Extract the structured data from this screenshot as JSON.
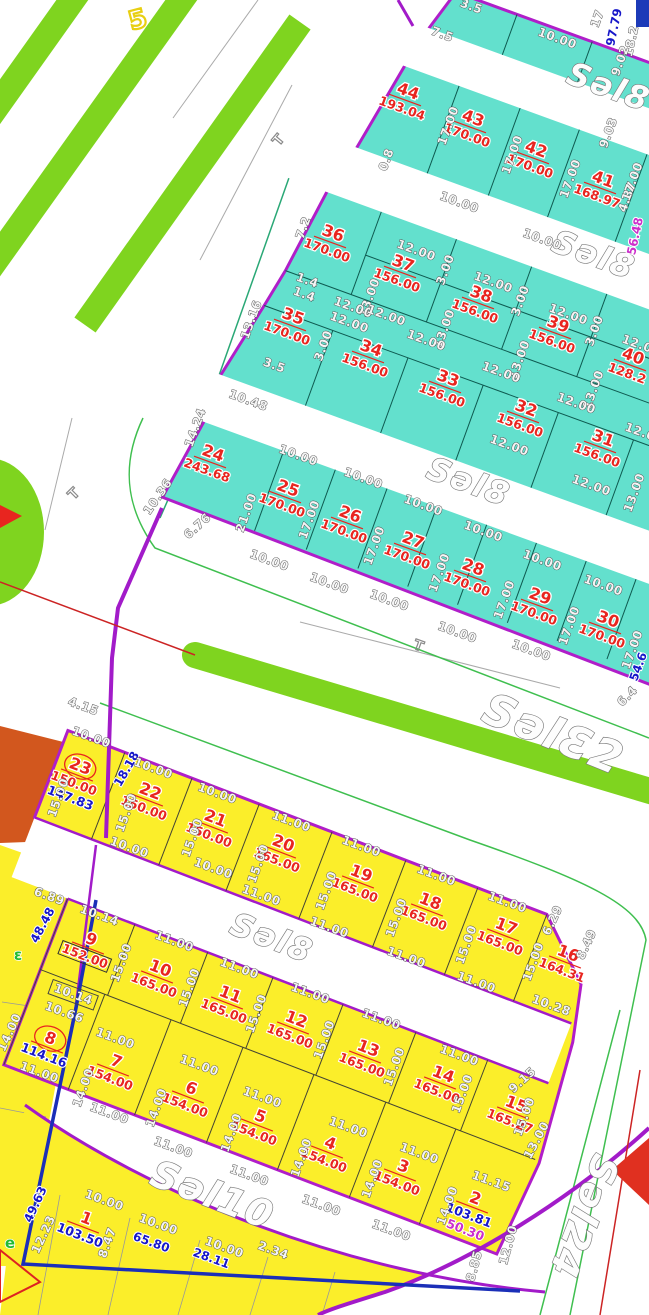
{
  "map_title": "cadastral-parcel-plan",
  "colors": {
    "cyan_block": "#63e0cd",
    "yellow_block": "#fbee2a",
    "green_strip": "#7fd41f",
    "purple_road": "#a21bc9",
    "block_border": "#b01ec9",
    "parcel_red": "#e8251f",
    "dim_blue": "#1717c9",
    "dim_magenta": "#cb2fcb",
    "orange_area": "#d2571e",
    "survey_blue": "#1b2fb8",
    "red_line": "#cc2424",
    "teal_line": "#2aa876",
    "green_line": "#3fbf4f"
  },
  "street_labels": [
    {
      "text": "Səl8",
      "x": 605,
      "y": 97,
      "r": 20,
      "s": 32
    },
    {
      "text": "Səl8",
      "x": 590,
      "y": 265,
      "r": 20,
      "s": 32
    },
    {
      "text": "Səl8",
      "x": 465,
      "y": 492,
      "r": 20,
      "s": 32
    },
    {
      "text": "SəlƐ2",
      "x": 548,
      "y": 748,
      "r": 22,
      "s": 44
    },
    {
      "text": "Səl8",
      "x": 268,
      "y": 948,
      "r": 21,
      "s": 32
    },
    {
      "text": "Səl10",
      "x": 208,
      "y": 1207,
      "r": 21,
      "s": 38
    },
    {
      "text": "Səl24",
      "x": 572,
      "y": 1212,
      "r": 111,
      "s": 38
    }
  ],
  "parcels": {
    "cyan": [
      {
        "no": "44",
        "area": "193.04",
        "x": 405,
        "y": 100,
        "r": 20
      },
      {
        "no": "43",
        "area": "170.00",
        "x": 470,
        "y": 127,
        "r": 20
      },
      {
        "no": "42",
        "area": "170.00",
        "x": 533,
        "y": 158,
        "r": 20
      },
      {
        "no": "41",
        "area": "168.97",
        "x": 600,
        "y": 188,
        "r": 20
      },
      {
        "no": "36",
        "area": "170.00",
        "x": 330,
        "y": 242,
        "r": 20
      },
      {
        "no": "37",
        "area": "156.00",
        "x": 400,
        "y": 272,
        "r": 20
      },
      {
        "no": "38",
        "area": "156.00",
        "x": 478,
        "y": 303,
        "r": 20
      },
      {
        "no": "39",
        "area": "156.00",
        "x": 555,
        "y": 333,
        "r": 20
      },
      {
        "no": "40",
        "area": "128.2",
        "x": 630,
        "y": 365,
        "r": 20
      },
      {
        "no": "35",
        "area": "170.00",
        "x": 290,
        "y": 325,
        "r": 20
      },
      {
        "no": "34",
        "area": "156.00",
        "x": 368,
        "y": 357,
        "r": 20
      },
      {
        "no": "33",
        "area": "156.00",
        "x": 445,
        "y": 387,
        "r": 20
      },
      {
        "no": "32",
        "area": "156.00",
        "x": 523,
        "y": 417,
        "r": 20
      },
      {
        "no": "31",
        "area": "156.00",
        "x": 600,
        "y": 447,
        "r": 20
      },
      {
        "no": "24",
        "area": "243.68",
        "x": 210,
        "y": 462,
        "r": 20
      },
      {
        "no": "25",
        "area": "170.00",
        "x": 285,
        "y": 497,
        "r": 20
      },
      {
        "no": "26",
        "area": "170.00",
        "x": 347,
        "y": 523,
        "r": 20
      },
      {
        "no": "27",
        "area": "170.00",
        "x": 410,
        "y": 549,
        "r": 20
      },
      {
        "no": "28",
        "area": "170.00",
        "x": 470,
        "y": 576,
        "r": 20
      },
      {
        "no": "29",
        "area": "170.00",
        "x": 537,
        "y": 605,
        "r": 20
      },
      {
        "no": "30",
        "area": "170.00",
        "x": 605,
        "y": 628,
        "r": 20
      }
    ],
    "yellow": [
      {
        "no": "23",
        "area": "150.00",
        "x": 77,
        "y": 775,
        "r": 21,
        "circled": true,
        "extra": "147.83",
        "extra_color": "#1717c9"
      },
      {
        "no": "22",
        "area": "150.00",
        "x": 147,
        "y": 800,
        "r": 21
      },
      {
        "no": "21",
        "area": "150.00",
        "x": 212,
        "y": 827,
        "r": 21
      },
      {
        "no": "20",
        "area": "165.00",
        "x": 280,
        "y": 852,
        "r": 21
      },
      {
        "no": "19",
        "area": "165.00",
        "x": 358,
        "y": 882,
        "r": 21
      },
      {
        "no": "18",
        "area": "165.00",
        "x": 427,
        "y": 910,
        "r": 21
      },
      {
        "no": "17",
        "area": "165.00",
        "x": 503,
        "y": 935,
        "r": 21
      },
      {
        "no": "16",
        "area": "164.31",
        "x": 565,
        "y": 962,
        "r": 21
      },
      {
        "no": "9",
        "area": "152.00",
        "x": 88,
        "y": 948,
        "r": 21,
        "boxed": true
      },
      {
        "no": "10",
        "area": "165.00",
        "x": 157,
        "y": 977,
        "r": 21
      },
      {
        "no": "11",
        "area": "165.00",
        "x": 227,
        "y": 1003,
        "r": 21
      },
      {
        "no": "12",
        "area": "165.00",
        "x": 293,
        "y": 1028,
        "r": 21
      },
      {
        "no": "13",
        "area": "165.00",
        "x": 365,
        "y": 1057,
        "r": 21
      },
      {
        "no": "14",
        "area": "165.00",
        "x": 440,
        "y": 1083,
        "r": 21
      },
      {
        "no": "15",
        "area": "165.27",
        "x": 513,
        "y": 1113,
        "r": 21
      },
      {
        "no": "8",
        "area": "114.16",
        "x": 47,
        "y": 1047,
        "r": 21,
        "circled": true,
        "area_blue": true
      },
      {
        "no": "7",
        "area": "154.00",
        "x": 113,
        "y": 1070,
        "r": 21
      },
      {
        "no": "6",
        "area": "154.00",
        "x": 188,
        "y": 1097,
        "r": 21
      },
      {
        "no": "5",
        "area": "154.00",
        "x": 257,
        "y": 1125,
        "r": 21
      },
      {
        "no": "4",
        "area": "154.00",
        "x": 327,
        "y": 1152,
        "r": 21
      },
      {
        "no": "3",
        "area": "154.00",
        "x": 400,
        "y": 1175,
        "r": 21
      },
      {
        "no": "2",
        "area": "103.81",
        "x": 472,
        "y": 1207,
        "r": 21,
        "area_blue": true,
        "extra": "50.30",
        "extra_color": "#cb2fcb"
      },
      {
        "no": "1",
        "area": "103.50",
        "x": 83,
        "y": 1227,
        "r": 21,
        "area_blue": true
      }
    ]
  },
  "dims": [
    {
      "t": "3.5",
      "x": 470,
      "y": 10,
      "r": 20
    },
    {
      "t": "7.5",
      "x": 441,
      "y": 38,
      "r": 20
    },
    {
      "t": "10.00",
      "x": 556,
      "y": 42,
      "r": 20
    },
    {
      "t": "17",
      "x": 601,
      "y": 20,
      "r": -70
    },
    {
      "t": "97.79",
      "x": 618,
      "y": 28,
      "r": -78,
      "c": "b"
    },
    {
      "t": "18.2",
      "x": 635,
      "y": 42,
      "r": -78
    },
    {
      "t": "9.02",
      "x": 624,
      "y": 62,
      "r": -70
    },
    {
      "t": "9.03",
      "x": 612,
      "y": 134,
      "r": -70
    },
    {
      "t": "4.87",
      "x": 631,
      "y": 198,
      "r": -70
    },
    {
      "t": "56.48",
      "x": 639,
      "y": 237,
      "r": -78,
      "c": "m"
    },
    {
      "t": "0.8",
      "x": 390,
      "y": 161,
      "r": -70
    },
    {
      "t": "17.00",
      "x": 452,
      "y": 127,
      "r": -70
    },
    {
      "t": "17.00",
      "x": 516,
      "y": 156,
      "r": -70
    },
    {
      "t": "17.00",
      "x": 574,
      "y": 180,
      "r": -70
    },
    {
      "t": "17.00",
      "x": 636,
      "y": 183,
      "r": -70
    },
    {
      "t": "10.00",
      "x": 458,
      "y": 206,
      "r": 20
    },
    {
      "t": "10.00",
      "x": 541,
      "y": 243,
      "r": 20
    },
    {
      "t": "7.2",
      "x": 307,
      "y": 229,
      "r": -70
    },
    {
      "t": "12.00",
      "x": 415,
      "y": 254,
      "r": 20
    },
    {
      "t": "12.00",
      "x": 492,
      "y": 286,
      "r": 20
    },
    {
      "t": "12.00",
      "x": 567,
      "y": 318,
      "r": 20
    },
    {
      "t": "12.00",
      "x": 640,
      "y": 349,
      "r": 20
    },
    {
      "t": "3.00",
      "x": 449,
      "y": 271,
      "r": -70
    },
    {
      "t": "3.00",
      "x": 524,
      "y": 302,
      "r": -70
    },
    {
      "t": "3.00",
      "x": 598,
      "y": 332,
      "r": -70
    },
    {
      "t": "13.00",
      "x": 373,
      "y": 299,
      "r": -70
    },
    {
      "t": "13.00",
      "x": 448,
      "y": 330,
      "r": -70
    },
    {
      "t": "13.00",
      "x": 523,
      "y": 361,
      "r": -70
    },
    {
      "t": "13.00",
      "x": 597,
      "y": 391,
      "r": -70
    },
    {
      "t": "1.4",
      "x": 306,
      "y": 284,
      "r": 20
    },
    {
      "t": "1.4",
      "x": 303,
      "y": 298,
      "r": 20
    },
    {
      "t": "12.00",
      "x": 352,
      "y": 311,
      "r": 20
    },
    {
      "t": "12.00",
      "x": 348,
      "y": 326,
      "r": 20
    },
    {
      "t": "12.00",
      "x": 425,
      "y": 344,
      "r": 20
    },
    {
      "t": "12.00",
      "x": 500,
      "y": 376,
      "r": 20
    },
    {
      "t": "12.00",
      "x": 575,
      "y": 407,
      "r": 20
    },
    {
      "t": "12.00",
      "x": 643,
      "y": 437,
      "r": 20
    },
    {
      "t": "13.16",
      "x": 255,
      "y": 321,
      "r": -70
    },
    {
      "t": "14.24",
      "x": 199,
      "y": 429,
      "r": -70
    },
    {
      "t": "10.48",
      "x": 247,
      "y": 404,
      "r": 20
    },
    {
      "t": "3.5",
      "x": 273,
      "y": 369,
      "r": 20
    },
    {
      "t": "3.00",
      "x": 327,
      "y": 347,
      "r": -70
    },
    {
      "t": "12.00",
      "x": 385,
      "y": 319,
      "r": 20
    },
    {
      "t": "12.00",
      "x": 508,
      "y": 449,
      "r": 20
    },
    {
      "t": "12.00",
      "x": 590,
      "y": 489,
      "r": 20
    },
    {
      "t": "13.00",
      "x": 638,
      "y": 494,
      "r": -70
    },
    {
      "t": "21.00",
      "x": 250,
      "y": 514,
      "r": -70
    },
    {
      "t": "10.36",
      "x": 161,
      "y": 499,
      "r": -55
    },
    {
      "t": "6.76",
      "x": 200,
      "y": 529,
      "r": -42
    },
    {
      "t": "10.00",
      "x": 297,
      "y": 459,
      "r": 20
    },
    {
      "t": "10.00",
      "x": 362,
      "y": 482,
      "r": 20
    },
    {
      "t": "10.00",
      "x": 422,
      "y": 509,
      "r": 20
    },
    {
      "t": "10.00",
      "x": 482,
      "y": 535,
      "r": 20
    },
    {
      "t": "10.00",
      "x": 541,
      "y": 564,
      "r": 20
    },
    {
      "t": "10.00",
      "x": 602,
      "y": 589,
      "r": 20
    },
    {
      "t": "17.00",
      "x": 313,
      "y": 521,
      "r": -70
    },
    {
      "t": "17.00",
      "x": 378,
      "y": 547,
      "r": -70
    },
    {
      "t": "17.00",
      "x": 443,
      "y": 574,
      "r": -70
    },
    {
      "t": "17.00",
      "x": 508,
      "y": 601,
      "r": -70
    },
    {
      "t": "17.00",
      "x": 573,
      "y": 627,
      "r": -70
    },
    {
      "t": "17.00",
      "x": 636,
      "y": 651,
      "r": -70
    },
    {
      "t": "10.00",
      "x": 268,
      "y": 564,
      "r": 20
    },
    {
      "t": "10.00",
      "x": 328,
      "y": 587,
      "r": 20
    },
    {
      "t": "10.00",
      "x": 388,
      "y": 604,
      "r": 20
    },
    {
      "t": "10.00",
      "x": 456,
      "y": 636,
      "r": 20
    },
    {
      "t": "10.00",
      "x": 530,
      "y": 654,
      "r": 20
    },
    {
      "t": "54.6",
      "x": 642,
      "y": 668,
      "r": -70,
      "c": "b"
    },
    {
      "t": "6.4",
      "x": 630,
      "y": 699,
      "r": -45
    },
    {
      "t": "4.15",
      "x": 82,
      "y": 710,
      "r": 20
    },
    {
      "t": "18.18",
      "x": 130,
      "y": 771,
      "r": -60,
      "c": "b"
    },
    {
      "t": "10.00",
      "x": 90,
      "y": 741,
      "r": 20
    },
    {
      "t": "10.00",
      "x": 152,
      "y": 772,
      "r": 20
    },
    {
      "t": "10.00",
      "x": 216,
      "y": 797,
      "r": 20
    },
    {
      "t": "11.00",
      "x": 290,
      "y": 825,
      "r": 20
    },
    {
      "t": "11.00",
      "x": 360,
      "y": 850,
      "r": 20
    },
    {
      "t": "11.00",
      "x": 435,
      "y": 879,
      "r": 20
    },
    {
      "t": "11.00",
      "x": 506,
      "y": 906,
      "r": 20
    },
    {
      "t": "6.29",
      "x": 556,
      "y": 922,
      "r": -65
    },
    {
      "t": "8.49",
      "x": 590,
      "y": 946,
      "r": -65
    },
    {
      "t": "15.00",
      "x": 62,
      "y": 799,
      "r": -70
    },
    {
      "t": "15.00",
      "x": 130,
      "y": 814,
      "r": -70
    },
    {
      "t": "15.00",
      "x": 196,
      "y": 839,
      "r": -70
    },
    {
      "t": "15.00",
      "x": 262,
      "y": 865,
      "r": -70
    },
    {
      "t": "15.00",
      "x": 330,
      "y": 892,
      "r": -70
    },
    {
      "t": "15.00",
      "x": 400,
      "y": 919,
      "r": -70
    },
    {
      "t": "15.00",
      "x": 470,
      "y": 946,
      "r": -70
    },
    {
      "t": "15.00",
      "x": 537,
      "y": 963,
      "r": -70
    },
    {
      "t": "10.00",
      "x": 128,
      "y": 851,
      "r": 20
    },
    {
      "t": "10.00",
      "x": 212,
      "y": 872,
      "r": 20
    },
    {
      "t": "11.00",
      "x": 260,
      "y": 899,
      "r": 20
    },
    {
      "t": "11.00",
      "x": 328,
      "y": 931,
      "r": 20
    },
    {
      "t": "11.00",
      "x": 405,
      "y": 961,
      "r": 20
    },
    {
      "t": "11.00",
      "x": 475,
      "y": 986,
      "r": 20
    },
    {
      "t": "10.28",
      "x": 550,
      "y": 1009,
      "r": 20
    },
    {
      "t": "6.89",
      "x": 48,
      "y": 900,
      "r": 20
    },
    {
      "t": "10.14",
      "x": 98,
      "y": 919,
      "r": 20
    },
    {
      "t": "48.48",
      "x": 46,
      "y": 927,
      "r": -62,
      "c": "b"
    },
    {
      "t": "11.00",
      "x": 173,
      "y": 945,
      "r": 20
    },
    {
      "t": "11.00",
      "x": 238,
      "y": 972,
      "r": 20
    },
    {
      "t": "11.00",
      "x": 309,
      "y": 997,
      "r": 20
    },
    {
      "t": "11.00",
      "x": 380,
      "y": 1023,
      "r": 20
    },
    {
      "t": "11.00",
      "x": 458,
      "y": 1059,
      "r": 20
    },
    {
      "t": "15.00",
      "x": 125,
      "y": 964,
      "r": -70
    },
    {
      "t": "15.00",
      "x": 193,
      "y": 989,
      "r": -70
    },
    {
      "t": "15.00",
      "x": 260,
      "y": 1015,
      "r": -70
    },
    {
      "t": "15.00",
      "x": 328,
      "y": 1041,
      "r": -70
    },
    {
      "t": "15.00",
      "x": 398,
      "y": 1068,
      "r": -70
    },
    {
      "t": "15.00",
      "x": 466,
      "y": 1095,
      "r": -70
    },
    {
      "t": "15.00",
      "x": 528,
      "y": 1118,
      "r": -70
    },
    {
      "t": "9.15",
      "x": 525,
      "y": 1083,
      "r": -42
    },
    {
      "t": "13.00",
      "x": 540,
      "y": 1142,
      "r": -62
    },
    {
      "t": "10.14",
      "x": 72,
      "y": 998,
      "r": 20,
      "bx": 1
    },
    {
      "t": "10.66",
      "x": 63,
      "y": 1016,
      "r": 20
    },
    {
      "t": "14.00",
      "x": 13,
      "y": 1034,
      "r": -65
    },
    {
      "t": "11.00",
      "x": 114,
      "y": 1042,
      "r": 20
    },
    {
      "t": "11.00",
      "x": 198,
      "y": 1069,
      "r": 20
    },
    {
      "t": "11.00",
      "x": 261,
      "y": 1101,
      "r": 20
    },
    {
      "t": "11.00",
      "x": 347,
      "y": 1131,
      "r": 20
    },
    {
      "t": "11.00",
      "x": 418,
      "y": 1157,
      "r": 20
    },
    {
      "t": "11.15",
      "x": 490,
      "y": 1185,
      "r": 20
    },
    {
      "t": "14.00",
      "x": 87,
      "y": 1089,
      "r": -70
    },
    {
      "t": "14.00",
      "x": 160,
      "y": 1109,
      "r": -70
    },
    {
      "t": "14.00",
      "x": 235,
      "y": 1134,
      "r": -70
    },
    {
      "t": "14.00",
      "x": 305,
      "y": 1159,
      "r": -70
    },
    {
      "t": "14.00",
      "x": 376,
      "y": 1180,
      "r": -70
    },
    {
      "t": "14.00",
      "x": 451,
      "y": 1207,
      "r": -70
    },
    {
      "t": "11.00",
      "x": 38,
      "y": 1076,
      "r": 20
    },
    {
      "t": "11.00",
      "x": 108,
      "y": 1117,
      "r": 20
    },
    {
      "t": "11.00",
      "x": 172,
      "y": 1151,
      "r": 20
    },
    {
      "t": "11.00",
      "x": 248,
      "y": 1179,
      "r": 20
    },
    {
      "t": "11.00",
      "x": 320,
      "y": 1209,
      "r": 20
    },
    {
      "t": "11.00",
      "x": 390,
      "y": 1234,
      "r": 20
    },
    {
      "t": "49.63",
      "x": 39,
      "y": 1206,
      "r": -65,
      "c": "b"
    },
    {
      "t": "12.23",
      "x": 47,
      "y": 1236,
      "r": -65
    },
    {
      "t": "8.47",
      "x": 111,
      "y": 1244,
      "r": -70
    },
    {
      "t": "10.00",
      "x": 103,
      "y": 1204,
      "r": 20
    },
    {
      "t": "10.00",
      "x": 157,
      "y": 1228,
      "r": 20
    },
    {
      "t": "10.00",
      "x": 223,
      "y": 1251,
      "r": 20
    },
    {
      "t": "65.80",
      "x": 150,
      "y": 1246,
      "r": 20,
      "c": "b"
    },
    {
      "t": "28.11",
      "x": 210,
      "y": 1262,
      "r": 20,
      "c": "b"
    },
    {
      "t": "2.34",
      "x": 272,
      "y": 1254,
      "r": 20
    },
    {
      "t": "8.85",
      "x": 478,
      "y": 1267,
      "r": -75
    },
    {
      "t": "12.00",
      "x": 512,
      "y": 1246,
      "r": -75
    },
    {
      "t": "T",
      "x": 282,
      "y": 143,
      "r": -50,
      "c": "t"
    },
    {
      "t": "T",
      "x": 77,
      "y": 497,
      "r": -45,
      "c": "t"
    },
    {
      "t": "T",
      "x": 417,
      "y": 650,
      "r": 20,
      "c": "t"
    },
    {
      "t": "5",
      "x": 140,
      "y": 28,
      "r": -15,
      "c": "y"
    },
    {
      "t": "ε",
      "x": 18,
      "y": 960,
      "r": 0,
      "c": "g"
    },
    {
      "t": "e",
      "x": 10,
      "y": 1248,
      "r": 0,
      "c": "g"
    }
  ]
}
